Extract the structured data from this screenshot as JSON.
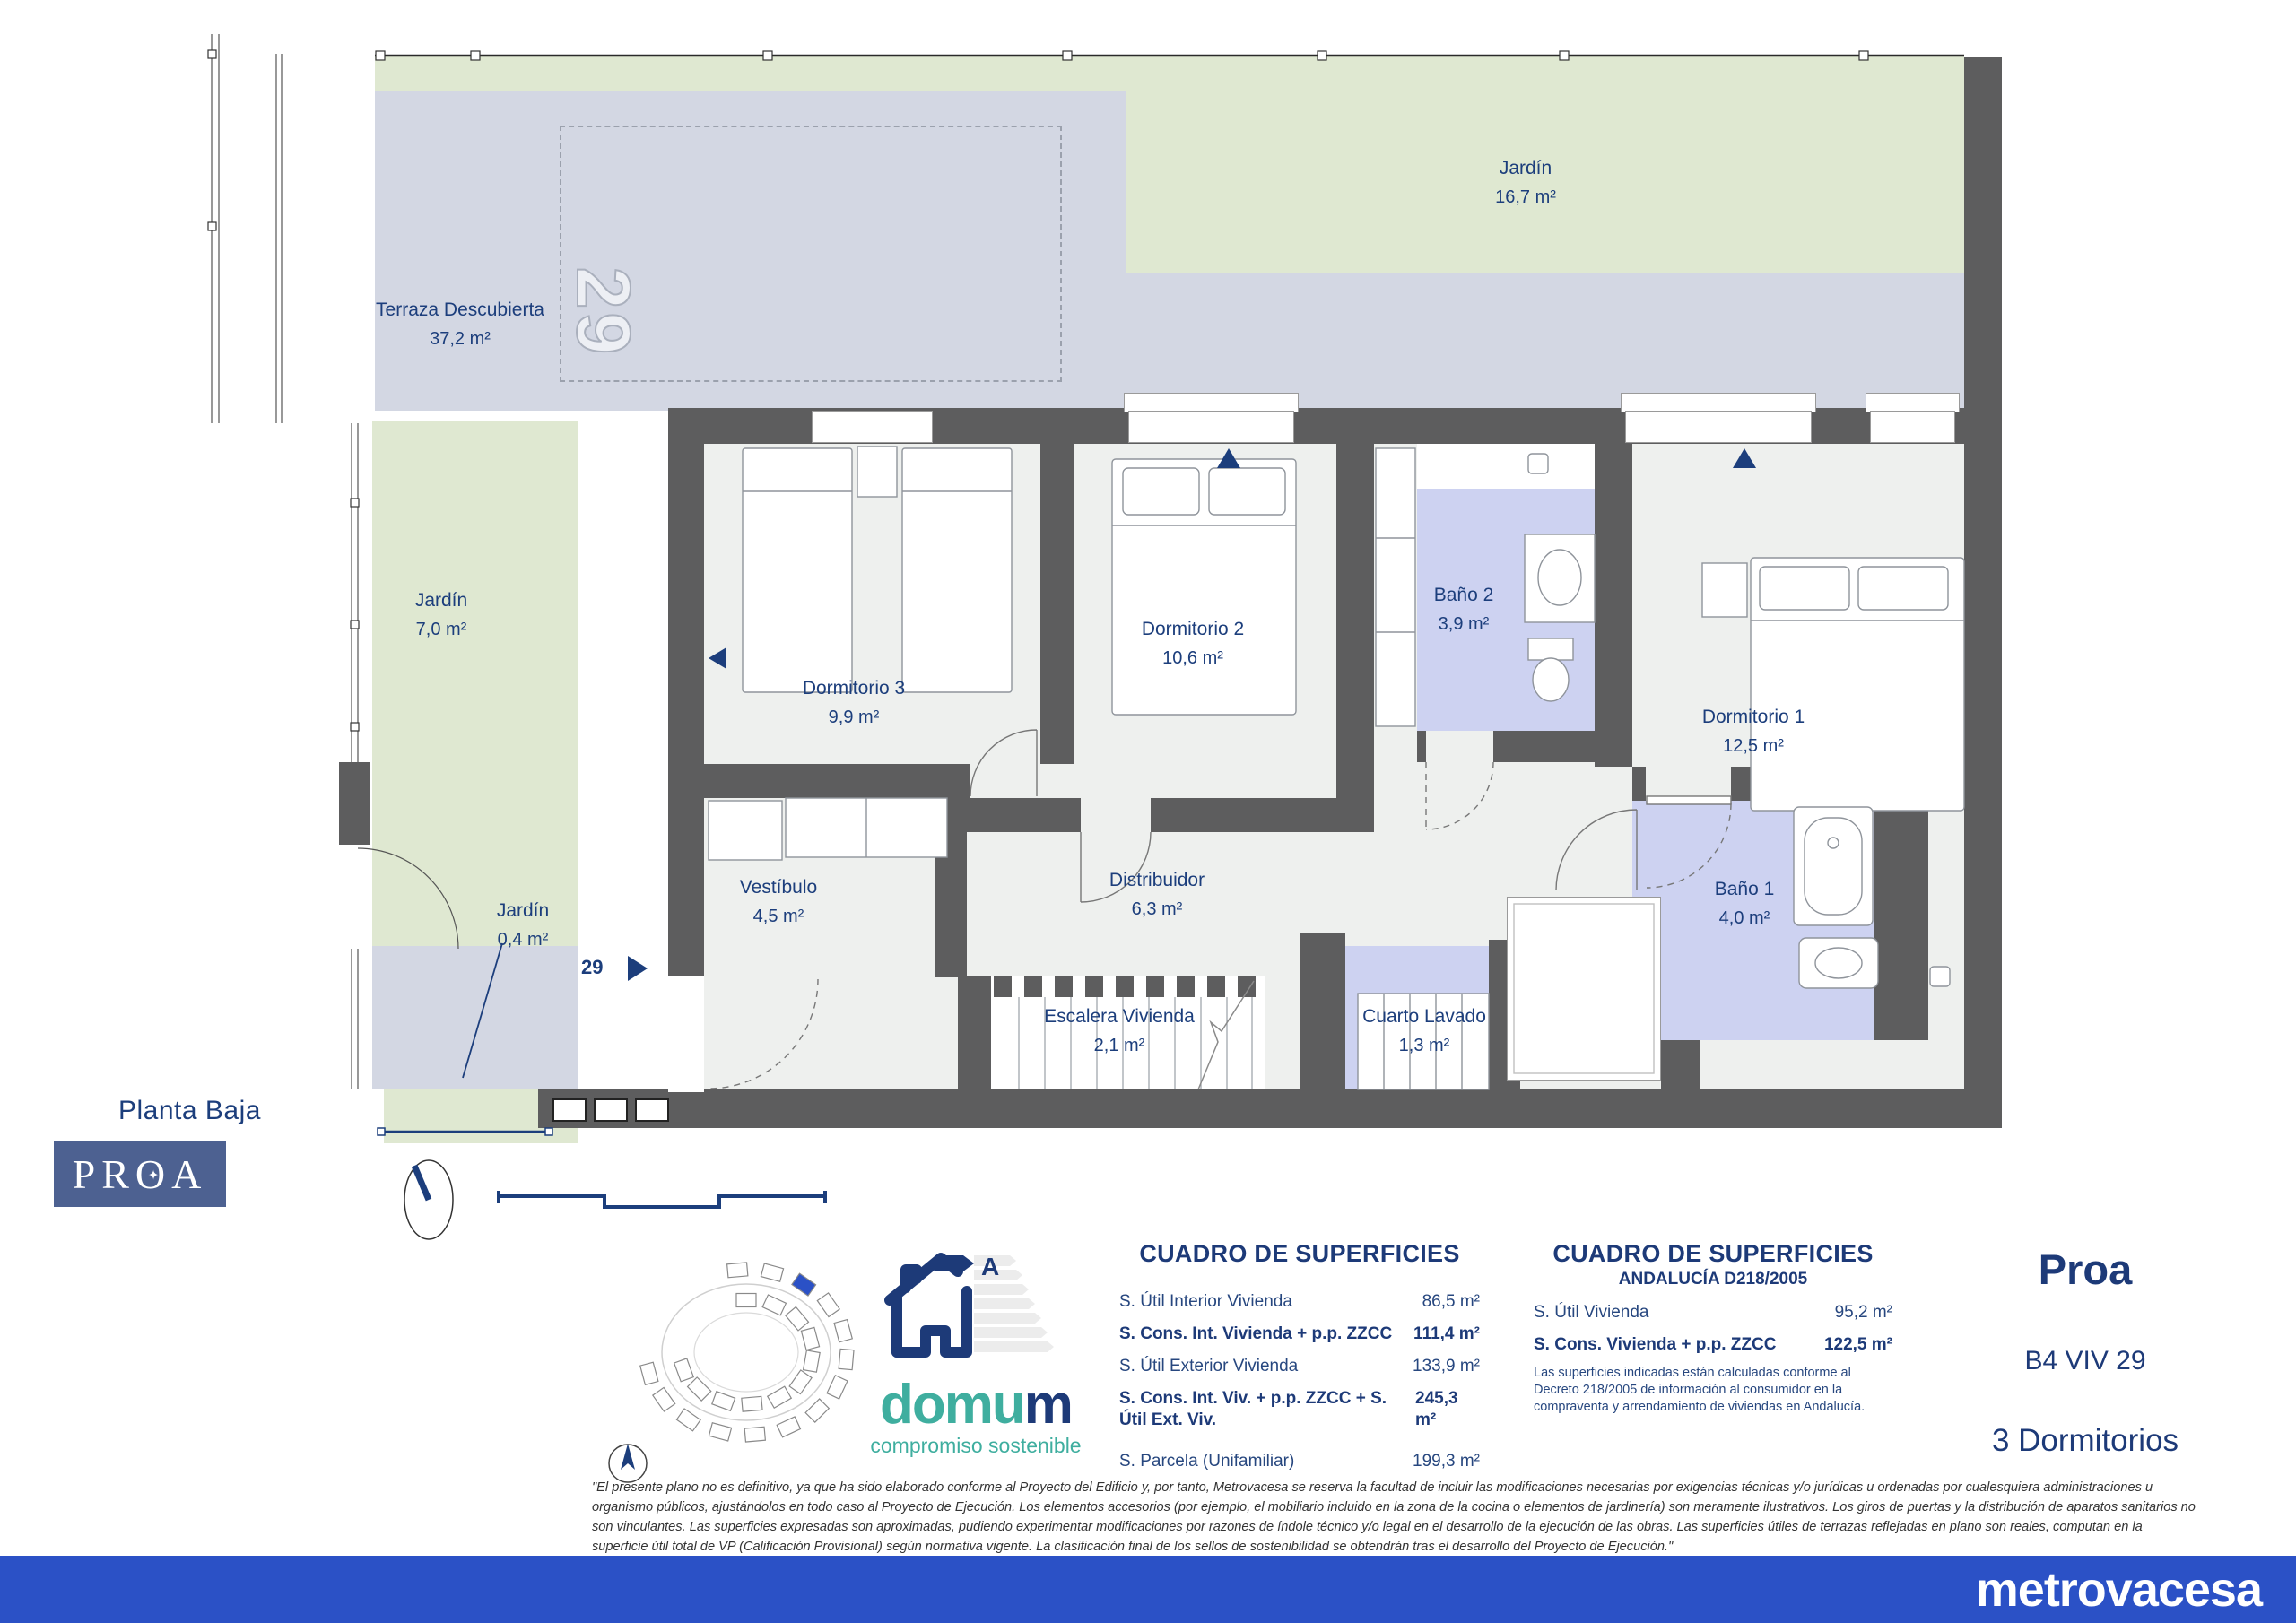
{
  "plan": {
    "floor_label": "Planta Baja",
    "unit_number": "29",
    "unit_marker": "29",
    "rooms": {
      "terraza": {
        "name": "Terraza Descubierta",
        "area": "37,2 m²"
      },
      "jardin_top": {
        "name": "Jardín",
        "area": "16,7 m²"
      },
      "jardin_left": {
        "name": "Jardín",
        "area": "7,0 m²"
      },
      "jardin_small": {
        "name": "Jardín",
        "area": "0,4 m²"
      },
      "dormitorio3": {
        "name": "Dormitorio 3",
        "area": "9,9 m²"
      },
      "dormitorio2": {
        "name": "Dormitorio 2",
        "area": "10,6 m²"
      },
      "bano2": {
        "name": "Baño 2",
        "area": "3,9 m²"
      },
      "dormitorio1": {
        "name": "Dormitorio 1",
        "area": "12,5 m²"
      },
      "vestibulo": {
        "name": "Vestíbulo",
        "area": "4,5 m²"
      },
      "distribuidor": {
        "name": "Distribuidor",
        "area": "6,3 m²"
      },
      "escalera": {
        "name": "Escalera Vivienda",
        "area": "2,1 m²"
      },
      "cuarto_lavado": {
        "name": "Cuarto Lavado",
        "area": "1,3 m²"
      },
      "bano1": {
        "name": "Baño 1",
        "area": "4,0 m²"
      }
    }
  },
  "surfaces_table_1": {
    "title": "CUADRO DE SUPERFICIES",
    "rows": [
      {
        "label": "S. Útil Interior Vivienda",
        "value": "86,5 m²"
      },
      {
        "label": "S. Cons. Int. Vivienda + p.p. ZZCC",
        "value": "111,4 m²"
      },
      {
        "label": "S. Útil Exterior Vivienda",
        "value": "133,9 m²"
      },
      {
        "label": "S. Cons. Int. Viv. + p.p. ZZCC + S. Útil Ext. Viv.",
        "value": "245,3 m²"
      },
      {
        "label": "S. Parcela (Unifamiliar)",
        "value": "199,3 m²"
      }
    ]
  },
  "surfaces_table_2": {
    "title": "CUADRO DE SUPERFICIES",
    "subtitle": "ANDALUCÍA D218/2005",
    "rows": [
      {
        "label": "S. Útil Vivienda",
        "value": "95,2 m²"
      },
      {
        "label": "S. Cons. Vivienda + p.p. ZZCC",
        "value": "122,5 m²"
      }
    ],
    "note": "Las superficies indicadas están calculadas conforme al Decreto 218/2005 de información al consumidor en la compraventa y arrendamiento de viviendas en Andalucía."
  },
  "unit_info": {
    "development": "Proa",
    "unit": "B4 VIV 29",
    "bedrooms": "3 Dormitorios"
  },
  "logos": {
    "proa": {
      "p1": "PR",
      "o": "O",
      "a": "A",
      "star": "✦"
    },
    "metrovacesa": "metrovacesa",
    "domum": {
      "brand_teal": "domu",
      "brand_blue": "m",
      "tagline": "compromiso sostenible",
      "energy_letter": "A"
    }
  },
  "disclaimer": {
    "lines": [
      "\"El presente plano no es definitivo, ya que ha sido elaborado conforme al Proyecto del Edificio y, por tanto, Metrovacesa se reserva la facultad de incluir las modificaciones necesarias por exigencias técnicas y/o jurídicas u ordenadas por cualesquiera administraciones u",
      "organismo públicos, ajustándolos en todo caso al Proyecto de Ejecución. Los elementos accesorios (por ejemplo, el mobiliario incluido en la zona de la cocina o elementos de jardinería) son meramente ilustrativos. Los giros de puertas y la distribución de aparatos sanitarios no",
      "son vinculantes. Las superficies expresadas son aproximadas, pudiendo experimentar modificaciones por razones de índole técnico y/o legal en el desarrollo de la ejecución de las obras. Las superficies útiles de terrazas reflejadas en plano son reales, computan en la",
      "superficie útil total de VP (Calificación Provisional) según normativa vigente. La clasificación final de los sellos de sostenibilidad se obtendrán tras el desarrollo del Proyecto de Ejecución.\""
    ]
  },
  "colors": {
    "navy": "#1d3a78",
    "metrovacesa_blue": "#2b51c6",
    "proa_slate": "#4d6191",
    "teal": "#3fae9f",
    "garden_green": "#dfe8d1",
    "terrace_lavender": "#d3d7e3",
    "bath_purple": "#cdd2f1",
    "wall_gray": "#5d5d5e",
    "floor_gray": "#eef0ee"
  }
}
